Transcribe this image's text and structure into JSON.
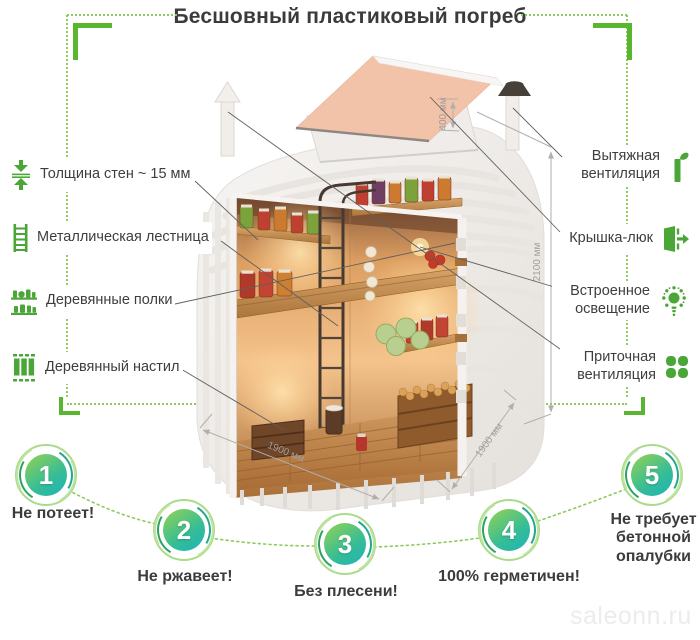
{
  "title": "Бесшовный пластиковый погреб",
  "watermark": "saleonn.ru",
  "features_left": [
    {
      "label": "Толщина стен ~ 15 мм",
      "icon": "wall-thickness-icon"
    },
    {
      "label": "Металлическая лестница",
      "icon": "ladder-icon"
    },
    {
      "label": "Деревянные полки",
      "icon": "shelves-icon"
    },
    {
      "label": "Деревянный настил",
      "icon": "decking-icon"
    }
  ],
  "features_right": [
    {
      "label": "Вытяжная вентиляция",
      "icon": "exhaust-vent-icon"
    },
    {
      "label": "Крышка-люк",
      "icon": "hatch-door-icon"
    },
    {
      "label": "Встроенное освещение",
      "icon": "light-bulb-icon"
    },
    {
      "label": "Приточная вентиляция",
      "icon": "fan-icon"
    }
  ],
  "dimensions": {
    "hatch_height": "400 мм",
    "body_height": "2100 мм",
    "width": "1900 мм",
    "depth": "1900 мм"
  },
  "benefits": [
    {
      "number": "1",
      "label": "Не потеет!"
    },
    {
      "number": "2",
      "label": "Не ржавеет!"
    },
    {
      "number": "3",
      "label": "Без плесени!"
    },
    {
      "number": "4",
      "label": "100% герметичен!"
    },
    {
      "number": "5",
      "label": "Не требует бетонной опалубки"
    }
  ],
  "colors": {
    "accent_green": "#5ab62e",
    "icon_green": "#4aa637",
    "dotted_green": "#8ccb5f",
    "circle_gradient_start": "#8ed058",
    "circle_gradient_end": "#1fb3b8",
    "text_dark": "#3e3e3e",
    "dimension_gray": "#9f9d9b"
  }
}
